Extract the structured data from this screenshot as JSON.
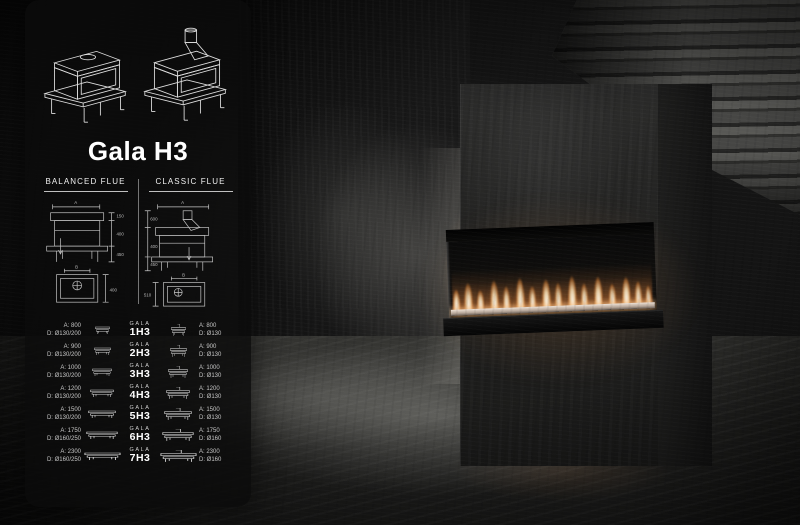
{
  "panel": {
    "title": "Gala H3",
    "brand": "GALA",
    "columns": {
      "left": "BALANCED FLUE",
      "right": "CLASSIC FLUE"
    },
    "diagram": {
      "dim_a": "A",
      "dim_b": "B",
      "left_heights": [
        "150",
        "400",
        "450"
      ],
      "left_depth": "400",
      "right_heights": [
        "600",
        "400",
        "450"
      ],
      "right_depth": "510"
    },
    "rows": [
      {
        "model": "1H3",
        "left_a": "A: 800",
        "left_d": "D: Ø130/200",
        "right_a": "A: 800",
        "right_d": "D: Ø130"
      },
      {
        "model": "2H3",
        "left_a": "A: 900",
        "left_d": "D: Ø130/200",
        "right_a": "A: 900",
        "right_d": "D: Ø130"
      },
      {
        "model": "3H3",
        "left_a": "A: 1000",
        "left_d": "D: Ø130/200",
        "right_a": "A: 1000",
        "right_d": "D: Ø130"
      },
      {
        "model": "4H3",
        "left_a": "A: 1200",
        "left_d": "D: Ø130/200",
        "right_a": "A: 1200",
        "right_d": "D: Ø130"
      },
      {
        "model": "5H3",
        "left_a": "A: 1500",
        "left_d": "D: Ø130/200",
        "right_a": "A: 1500",
        "right_d": "D: Ø130"
      },
      {
        "model": "6H3",
        "left_a": "A: 1750",
        "left_d": "D: Ø160/250",
        "right_a": "A: 1750",
        "right_d": "D: Ø160"
      },
      {
        "model": "7H3",
        "left_a": "A: 2300",
        "left_d": "D: Ø160/250",
        "right_a": "A: 2300",
        "right_d": "D: Ø160"
      }
    ],
    "icons": {
      "balanced": "balanced-flue-icon",
      "classic": "classic-flue-icon"
    }
  },
  "colors": {
    "flame_core": "#fffffa",
    "flame_mid": "#ffe7bc",
    "flame_glow": "#ff963c",
    "panel_text": "#e8e8e8"
  }
}
